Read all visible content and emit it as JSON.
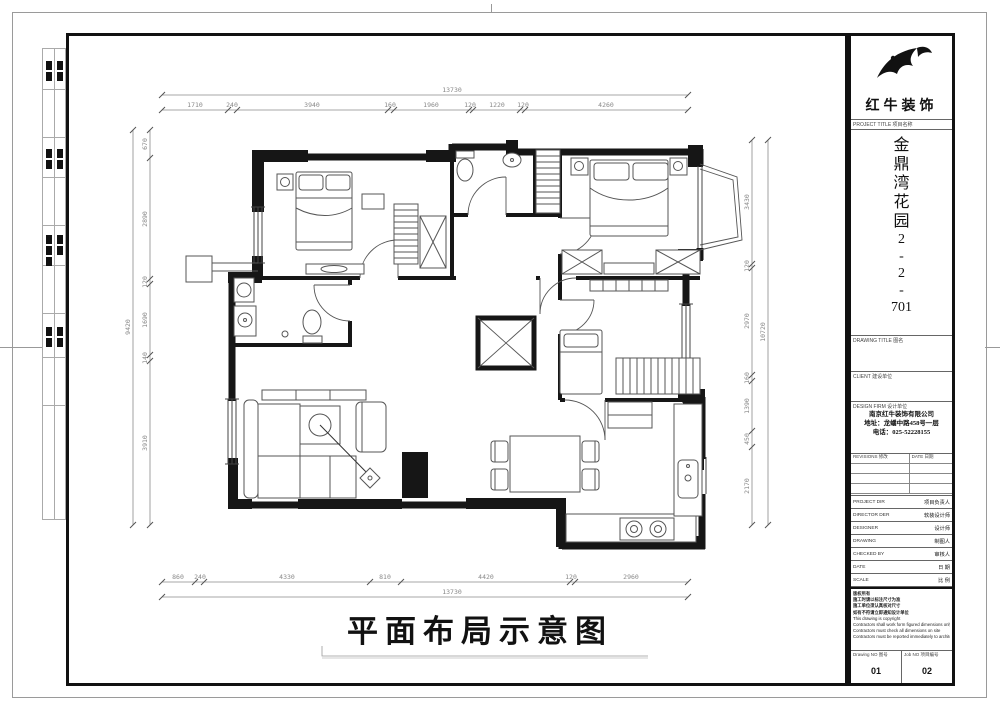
{
  "sheet": {
    "caption": "平面布局示意图"
  },
  "title_block": {
    "company": "红牛装饰",
    "project_title_label": "PROJECT TITLE 项目名称",
    "project_name_chars": [
      "金",
      "鼎",
      "湾",
      "花",
      "园",
      "2",
      "-",
      "2",
      "-",
      "701"
    ],
    "drawing_title_label": "DRAWING TITLE 图名",
    "client_label": "CLIENT 建设单位",
    "design_firm_label": "DESIGN FIRM 设计单位",
    "firm_name": "南京红牛装饰有限公司",
    "firm_address": "地址：龙蟠中路458号一层",
    "firm_phone": "电话：025-52228155",
    "revisions_label": "REVISIONS 修改",
    "date_col_label": "DATE 日期",
    "rows": [
      {
        "label": "PROJECT DIR",
        "value": "项目负责人"
      },
      {
        "label": "DIRECTOR DER",
        "value": "软装设计师"
      },
      {
        "label": "DESIGNER",
        "value": "设计师"
      },
      {
        "label": "DRAWING",
        "value": "制图人"
      },
      {
        "label": "CHECKED BY",
        "value": "审核人"
      },
      {
        "label": "DATE",
        "value": "日 期"
      },
      {
        "label": "SCALE",
        "value": "比 例"
      }
    ],
    "notes": [
      "版权所有",
      "施工时请以标注尺寸为准",
      "施工单位须认真核对尺寸",
      "如有不符请立即通知设计单位",
      "This drawing is copyright",
      "Contractors shall work form figured dimensions only",
      "Contractors must check all dimensions on site",
      "Contractors must be reported immediately to architects"
    ],
    "drawing_no_label": "Drawing NO 图号",
    "drawing_no_value": "01",
    "job_no_label": "Job NO 项目编号",
    "job_no_value": "02"
  },
  "plan": {
    "dims": {
      "top_total": "13730",
      "top": [
        "1710",
        "240",
        "3940",
        "160",
        "1960",
        "120",
        "1220",
        "120",
        "4260"
      ],
      "bottom_total": "13730",
      "bottom": [
        "860",
        "240",
        "4330",
        "810",
        "4420",
        "120",
        "2960"
      ],
      "left_total": "9420",
      "left": [
        "670",
        "2890",
        "120",
        "1690",
        "140",
        "3910"
      ],
      "right_total": "10720",
      "right": [
        "3430",
        "120",
        "2970",
        "160",
        "1390",
        "450",
        "2170"
      ]
    }
  }
}
